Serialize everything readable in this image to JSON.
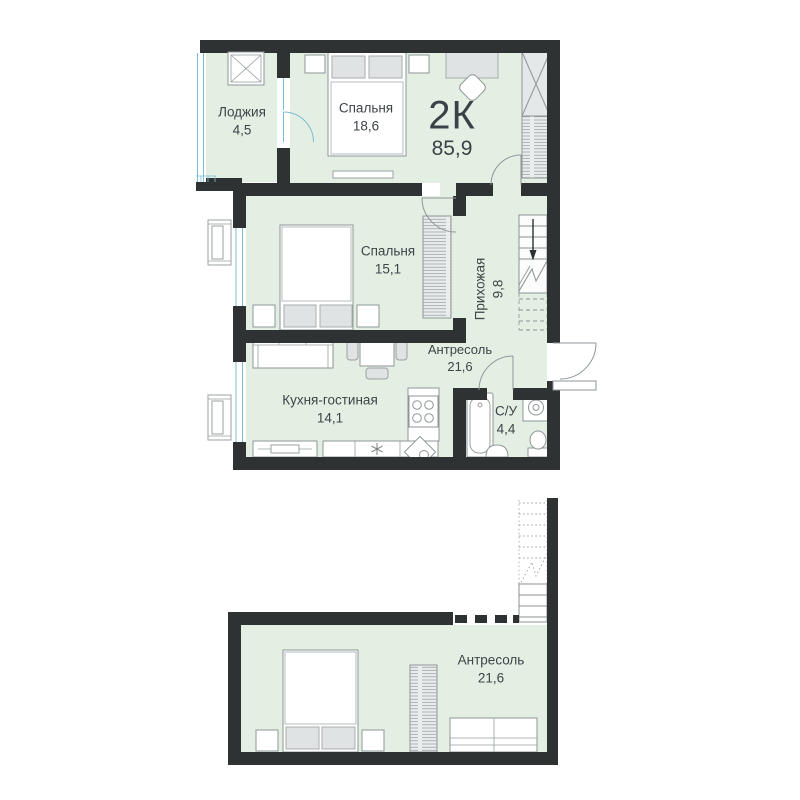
{
  "plan": {
    "type_label": "2К",
    "total_area": "85,9",
    "rooms": {
      "loggia": {
        "name": "Лоджия",
        "area": "4,5"
      },
      "bedroom_top": {
        "name": "Спальня",
        "area": "18,6"
      },
      "bedroom_mid": {
        "name": "Спальня",
        "area": "15,1"
      },
      "hallway": {
        "name": "Прихожая",
        "area": "9,8"
      },
      "mezzanine_ref": {
        "name": "Антресоль",
        "area": "21,6"
      },
      "kitchen_living": {
        "name": "Кухня-гостиная",
        "area": "14,1"
      },
      "bathroom": {
        "name": "С/У",
        "area": "4,4"
      },
      "mezzanine": {
        "name": "Антресоль",
        "area": "21,6"
      }
    },
    "colors": {
      "wall": "#2e3233",
      "room_fill": "#e4efe4",
      "glazing_blue": "#7cbcd6",
      "furniture_line": "#8f9698",
      "text": "#3d4448"
    }
  }
}
